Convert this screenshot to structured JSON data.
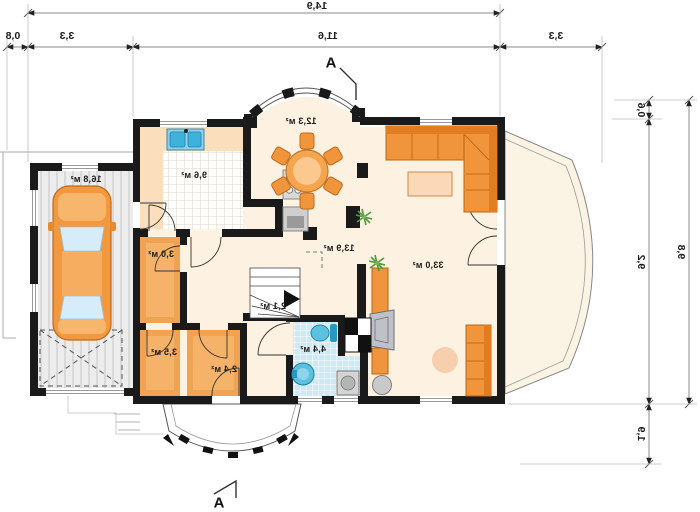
{
  "page": {
    "type": "house-floor-plan",
    "mirrored_print": true,
    "unit": "м²"
  },
  "rooms": {
    "garage": "16,8 м²",
    "kitchen": "9,6 м²",
    "dining": "12,3 м²",
    "living": "33,0 м²",
    "hall": "13,9 м²",
    "wardrobe": "3,0 м²",
    "stairs": "2,1 м²",
    "bathroom": "4,4 м²",
    "storage": "3,5 м²",
    "vestibule": "2,4 м²"
  },
  "dimensions": {
    "top": {
      "total": "14,9",
      "eaves": "0,8",
      "garage": "3,3",
      "house": "11,6",
      "terrace": "3,3"
    },
    "right": {
      "bay": "0,6",
      "house": "9,2",
      "porch": "1,9",
      "total": "9,8"
    }
  },
  "section_marker": "A",
  "colors": {
    "wall": "#1a1a1a",
    "floor_cream": "#fdf2e1",
    "counter_peach": "#fbdfbc",
    "furniture_orange": "#f0953c",
    "furniture_orange_dark": "#e07d22",
    "bath_tile_blue": "#cde9f4",
    "fixture_blue": "#45b4d8",
    "appliance_gray": "#c9c9c9",
    "dim_line_gray": "#777777",
    "plant_green": "#4e9a3c"
  }
}
